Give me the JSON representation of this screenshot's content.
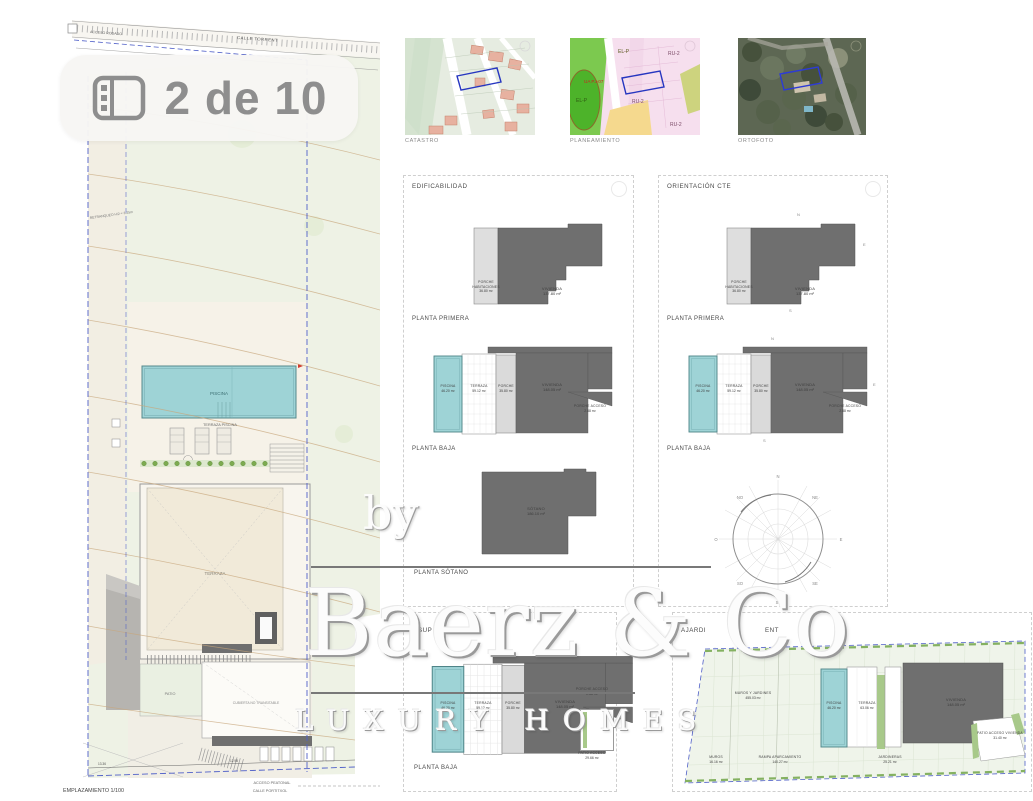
{
  "badge": {
    "label": "2 de 10"
  },
  "maps": {
    "catastro": {
      "caption": "CATASTRO"
    },
    "planeamiento": {
      "caption": "PLANEAMIENTO",
      "zone_elp_top": "EL-P",
      "zone_ua": "UA PJ-07",
      "zone_elp_left": "EL-P",
      "zone_ru2_a": "RU-2",
      "zone_ru2_b": "RU-2",
      "zone_ru2_c": "RU-2"
    },
    "ortofoto": {
      "caption": "ORTOFOTO"
    }
  },
  "site_plan": {
    "title": "EMPLAZAMIENTO 1/100",
    "street_top": "CALLE TORRENT",
    "access_top": "ACCESO RODADO",
    "setback": "RETRANQUEO H/2 = 3.25m",
    "pool": "PISCINA",
    "pool_terrace": "TERRAZA PISCINA",
    "terrace": "TERRAZA",
    "patio": "PATIO",
    "roof": "CUBIERTA NO TRANSITABLE",
    "access_bottom": "ACCESO PEATONAL",
    "street_bottom": "CALLE PORTITXOL",
    "dim_left": "13.36",
    "dim_right": "12.98"
  },
  "edificabilidad": {
    "title": "EDIFICABILIDAD",
    "planta_primera": "PLANTA PRIMERA",
    "planta_baja": "PLANTA BAJA",
    "planta_sotano": "PLANTA SÓTANO"
  },
  "orientacion": {
    "title": "ORIENTACIÓN CTE",
    "planta_primera": "PLANTA PRIMERA",
    "planta_baja": "PLANTA BAJA"
  },
  "compass": {
    "n": "N",
    "ne": "NE",
    "e": "E",
    "se": "SE",
    "s": "S",
    "so": "SO",
    "o": "O",
    "no": "NO"
  },
  "superficies_panel": {
    "title_left": "SUP",
    "title_right": "N",
    "planta_baja": "PLANTA BAJA"
  },
  "ajardinamiento_panel": {
    "title_left": "AJARDI",
    "title_right": "ENT"
  },
  "areas": {
    "p1_porche_habitaciones": {
      "line1": "PORCHE",
      "line2": "HABITACIONES",
      "value": "36.80 m²"
    },
    "p1_vivienda": {
      "line1": "VIVIENDA",
      "value": "137.80 m²"
    },
    "pb_piscina": {
      "line1": "PISCINA",
      "value": "46.20 m²"
    },
    "pb_terraza": {
      "line1": "TERRAZA",
      "value": "59.12 m²"
    },
    "pb_porche": {
      "line1": "PORCHE",
      "value": "35.80 m²"
    },
    "pb_vivienda": {
      "line1": "VIVIENDA",
      "value": "148.05 m²"
    },
    "pb_porche_acceso": {
      "line1": "PORCHE ACCESO",
      "value": "2.88 m²"
    },
    "sotano": {
      "line1": "SÓTANO",
      "value": "186.10 m²"
    },
    "sup_patio_acceso": {
      "line1": "PATIO ACCESO",
      "value": "29.66 m²"
    },
    "aj_muros_jardines": {
      "line1": "MUROS Y JARDINES",
      "value": "455.03 m²"
    },
    "aj_piscina": {
      "line1": "PISCINA",
      "value": "46.20 m²"
    },
    "aj_terraza": {
      "line1": "TERRAZA",
      "value": "63.06 m²"
    },
    "aj_vivienda": {
      "line1": "VIVIENDA",
      "value": "148.05 m²"
    },
    "aj_patio_acceso": {
      "line1": "PATIO ACCESO VIVIENDA",
      "value": "31.40 m²"
    },
    "aj_muros": {
      "line1": "MUROS",
      "value": "16.16 m²"
    },
    "aj_rampa": {
      "line1": "RAMPA APARCAMIENTO",
      "value": "140.27 m²"
    },
    "aj_jardineras": {
      "line1": "JARDINERAS",
      "value": "25.21 m²"
    }
  },
  "watermark": {
    "by": "by",
    "brand": "Baerz & Co",
    "tagline": "LUXURY HOMES"
  }
}
